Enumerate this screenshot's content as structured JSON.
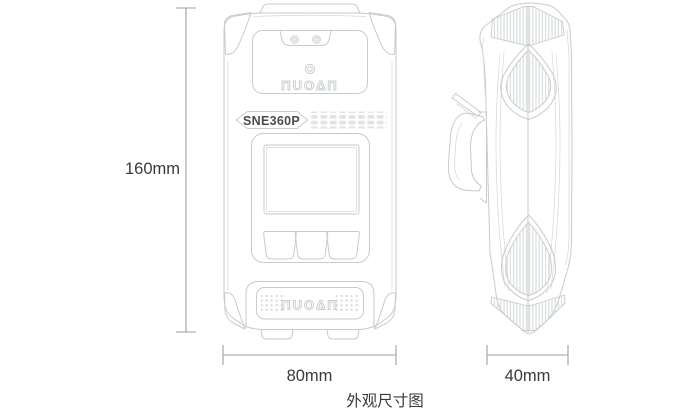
{
  "caption": "外观尺寸图",
  "device": {
    "model": "SNE360P",
    "brand": "NUOAN",
    "brand_logo": "ΠUOΔΠ"
  },
  "dimensions": {
    "height": "160mm",
    "width": "80mm",
    "depth": "40mm"
  },
  "colors": {
    "line": "#c6cbce",
    "line_soft": "#d7dbdd",
    "hatch": "#d2d6d9",
    "dim_line": "#9b9fa2",
    "text": "#3a3a3e",
    "model_text": "#4b4b4f"
  }
}
